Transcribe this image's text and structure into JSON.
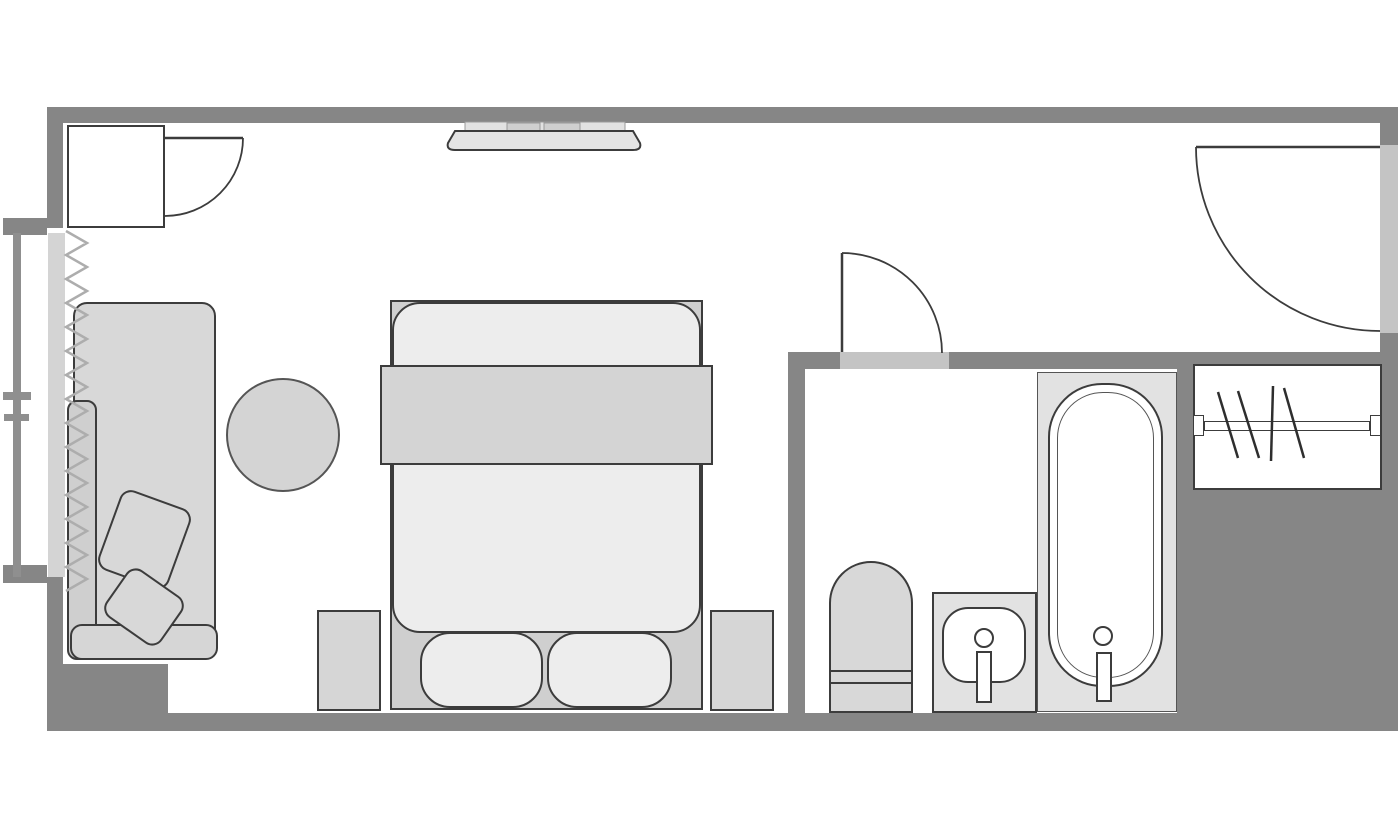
{
  "meta": {
    "type": "floor-plan",
    "subject": "hotel-guest-room-floor-plan",
    "canvas_width": 1400,
    "canvas_height": 840,
    "visible_text": []
  },
  "colors": {
    "wall": "#868686",
    "threshold": "#c4c4c4",
    "glass": "#d4d4d4",
    "railing": "#8f8f8f",
    "line": "#3c3c3c",
    "line-soft": "#555555",
    "curtain": "#adadad",
    "fill-light": "#ededed",
    "fill-mid": "#d6d6d6",
    "fill-soft": "#e2e2e2",
    "fill-body": "#d8d8d8",
    "fill-frame": "#cfcfcf",
    "fill-duvet": "#d4d4d4",
    "fill-tv": "#e4e4e4",
    "white": "#ffffff",
    "bg": "#ffffff"
  },
  "rooms": [
    {
      "name": "bedroom"
    },
    {
      "name": "bathroom"
    },
    {
      "name": "entry-hall"
    },
    {
      "name": "closet"
    },
    {
      "name": "balcony"
    }
  ],
  "elements": {
    "doors": [
      {
        "name": "connecting-door",
        "location": "top-left",
        "symbol": "leaf-with-quarter-arc"
      },
      {
        "name": "bathroom-door",
        "location": "bathroom-top-wall",
        "symbol": "leaf-with-quarter-arc"
      },
      {
        "name": "entry-door",
        "location": "right-wall",
        "symbol": "leaf-with-quarter-arc"
      }
    ],
    "window": {
      "name": "balcony-window",
      "location": "left-wall",
      "curtain_zigzag": true,
      "railing_outside": true
    },
    "furniture": [
      {
        "name": "wall-tv",
        "count": 1
      },
      {
        "name": "double-bed",
        "count": 1
      },
      {
        "name": "pillow",
        "count": 2
      },
      {
        "name": "nightstand",
        "count": 2
      },
      {
        "name": "chaise-sofa",
        "count": 1
      },
      {
        "name": "sofa-cushion",
        "count": 2
      },
      {
        "name": "round-side-table",
        "count": 1
      },
      {
        "name": "toilet",
        "count": 1
      },
      {
        "name": "sink-vanity",
        "count": 1
      },
      {
        "name": "bathtub",
        "count": 1
      },
      {
        "name": "closet-rod",
        "count": 1
      },
      {
        "name": "clothes-hanger",
        "count": 4
      }
    ]
  }
}
